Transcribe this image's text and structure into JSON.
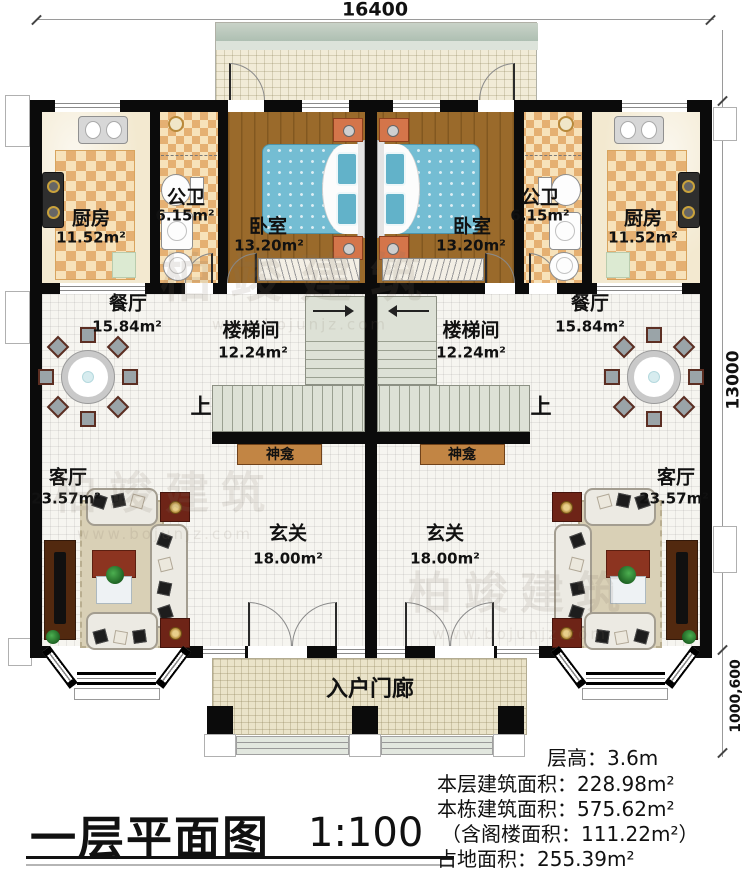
{
  "title_block": {
    "title": "一层平面图",
    "scale": "1:100"
  },
  "info_block": {
    "lines": [
      "层高：3.6m",
      "本层建筑面积：228.98m²",
      "本栋建筑面积：575.62m²",
      "（含阁楼面积：111.22m²）",
      "占地面积：255.39m²"
    ]
  },
  "dimensions": {
    "top_width": "16400",
    "right_height": "13000",
    "right_porch_depth": "1000,600"
  },
  "rooms": {
    "kitchen": {
      "name": "厨房",
      "area": "11.52m²"
    },
    "bathroom": {
      "name": "公卫",
      "area": "6.15m²"
    },
    "bedroom": {
      "name": "卧室",
      "area": "13.20m²"
    },
    "dining": {
      "name": "餐厅",
      "area": "15.84m²"
    },
    "stairwell": {
      "name": "楼梯间",
      "area": "12.24m²"
    },
    "living": {
      "name": "客厅",
      "area": "23.57m²"
    },
    "foyer": {
      "name": "玄关",
      "area": "18.00m²"
    }
  },
  "labels": {
    "shrine": "神龛",
    "up": "上",
    "porch": "入户门廊"
  },
  "watermark": {
    "name": "柏竣建筑",
    "url": "www.bojunjz.com"
  },
  "colors": {
    "wall": "#0b0b0b",
    "wood_floor": "#9a6a2b",
    "checker_dark": "#e5b072",
    "checker_light": "#f7e2ba",
    "bed_blue": "#74bdd3",
    "shrine_wood": "#c28544",
    "stair_fill": "#dde1d6"
  }
}
